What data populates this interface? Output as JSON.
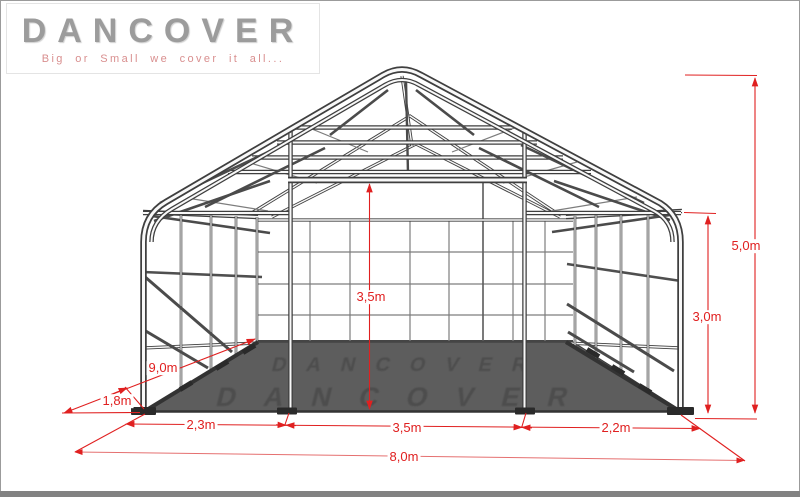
{
  "brand": {
    "title": "DANCOVER",
    "tagline": "Big or Small we cover it all..."
  },
  "diagram": {
    "type": "storage-tent-frame-front-perspective-drawing",
    "dimensions": {
      "ridge_height": "5,0m",
      "side_height": "3,0m",
      "door_clear_height": "3,5m",
      "depth": "9,0m",
      "bay_spacing": "1,8m",
      "left_section_width": "2,3m",
      "door_width": "3,5m",
      "right_section_width": "2,2m",
      "total_width": "8,0m"
    },
    "watermark": {
      "row1": "DANCOVER",
      "row2": "DANCOVER"
    }
  },
  "colors": {
    "dimension_red": "#e02020",
    "frame_dark": "#3f3f3f",
    "frame_light": "#f8f8f8",
    "floor_gray": "#5d5d5d",
    "logo_gray": "#9c9c9c",
    "tagline_pink": "#d98f8f",
    "footer_bar": "#828282"
  }
}
